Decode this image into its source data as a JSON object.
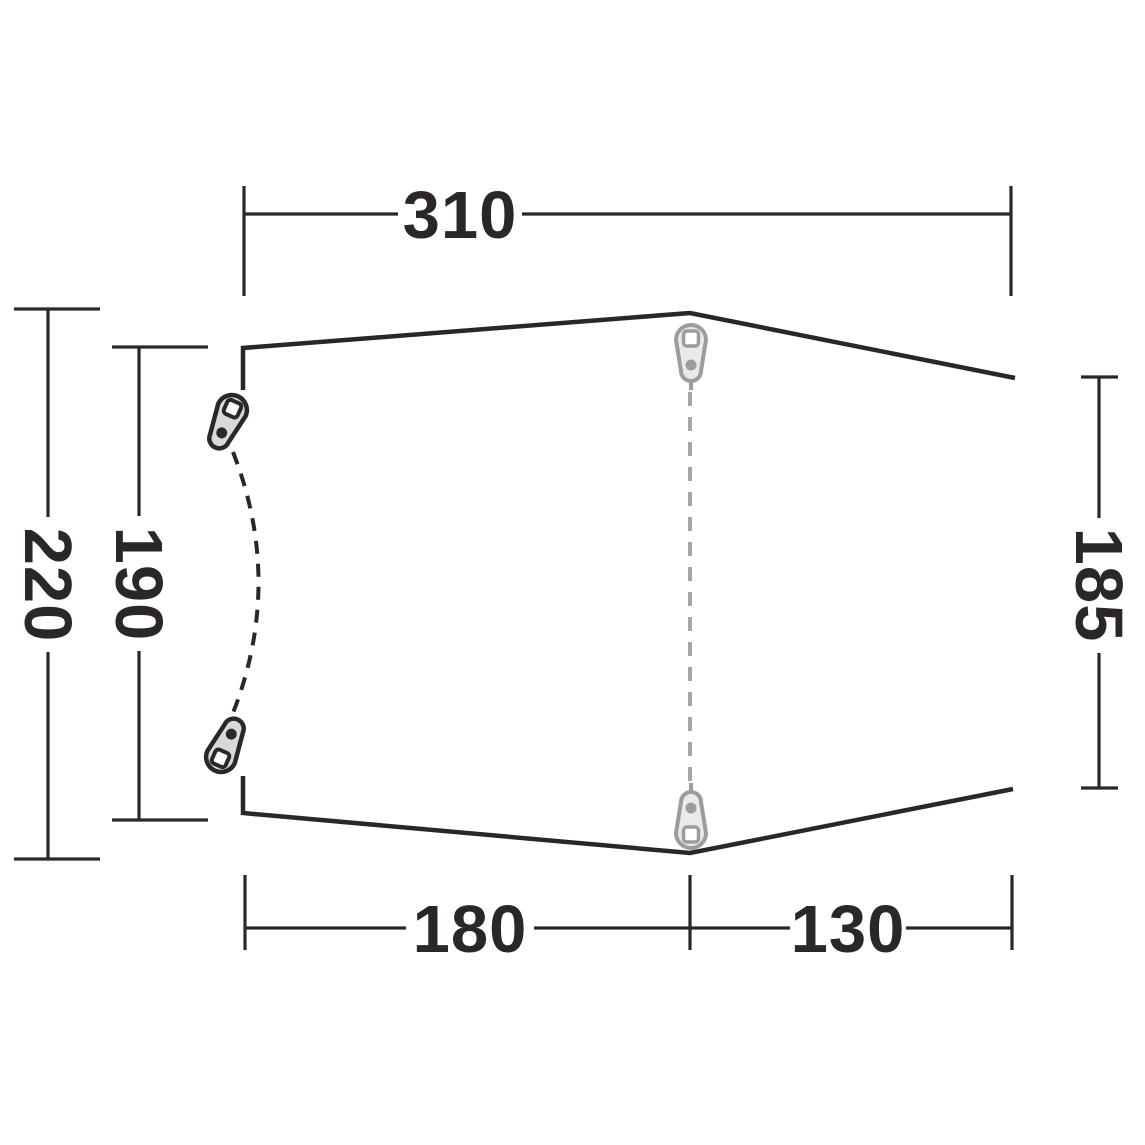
{
  "diagram": {
    "name": "tent-top-view-dimension-diagram",
    "dimensions": {
      "top_width": "310",
      "left_outer": "220",
      "left_inner": "190",
      "right_side": "185",
      "bottom_left": "180",
      "bottom_right": "130"
    },
    "colors": {
      "outline": "#2b2728",
      "dimension_lines": "#2b2728",
      "label_text": "#2b2728",
      "peg_gray_stroke": "#9c9c9c",
      "peg_gray_fill": "#eaeaea",
      "peg_dark_stroke": "#2b2728",
      "peg_dark_fill": "#d9d9d9",
      "dashed_center_line": "#a6a6a6",
      "background": "#ffffff"
    }
  }
}
